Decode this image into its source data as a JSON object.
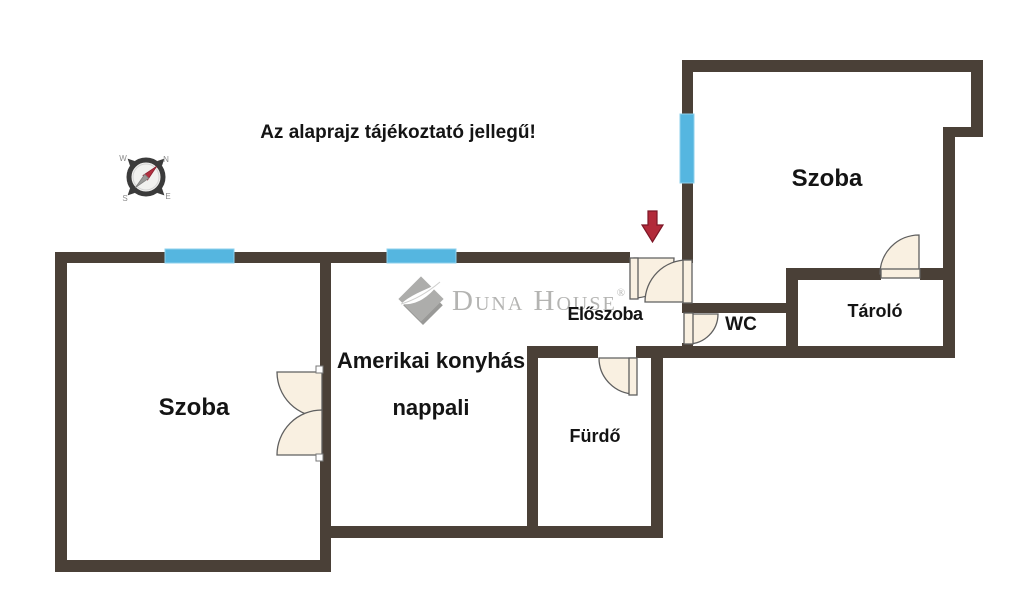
{
  "disclaimer": "Az alaprajz tájékoztató jellegű!",
  "watermark": {
    "brand": "Duna House",
    "registered_mark": "®"
  },
  "compass": {
    "n": "N",
    "e": "E",
    "s": "S",
    "w": "W"
  },
  "rooms": {
    "szoba_left": {
      "label": "Szoba"
    },
    "nappali": {
      "label": "Amerikai konyhás nappali",
      "line1": "Amerikai konyhás",
      "line2": "nappali"
    },
    "eloszoba": {
      "label": "Előszoba"
    },
    "furdo": {
      "label": "Fürdő"
    },
    "wc": {
      "label": "WC"
    },
    "tarolo": {
      "label": "Tároló"
    },
    "szoba_right": {
      "label": "Szoba"
    }
  },
  "colors": {
    "wall": "#4a4037",
    "window": "#55b6e0",
    "door_fill": "#f9f0e1",
    "entrance_arrow": "#b22a3a",
    "label_text": "#141414",
    "watermark_text": "#b4b4b2"
  }
}
